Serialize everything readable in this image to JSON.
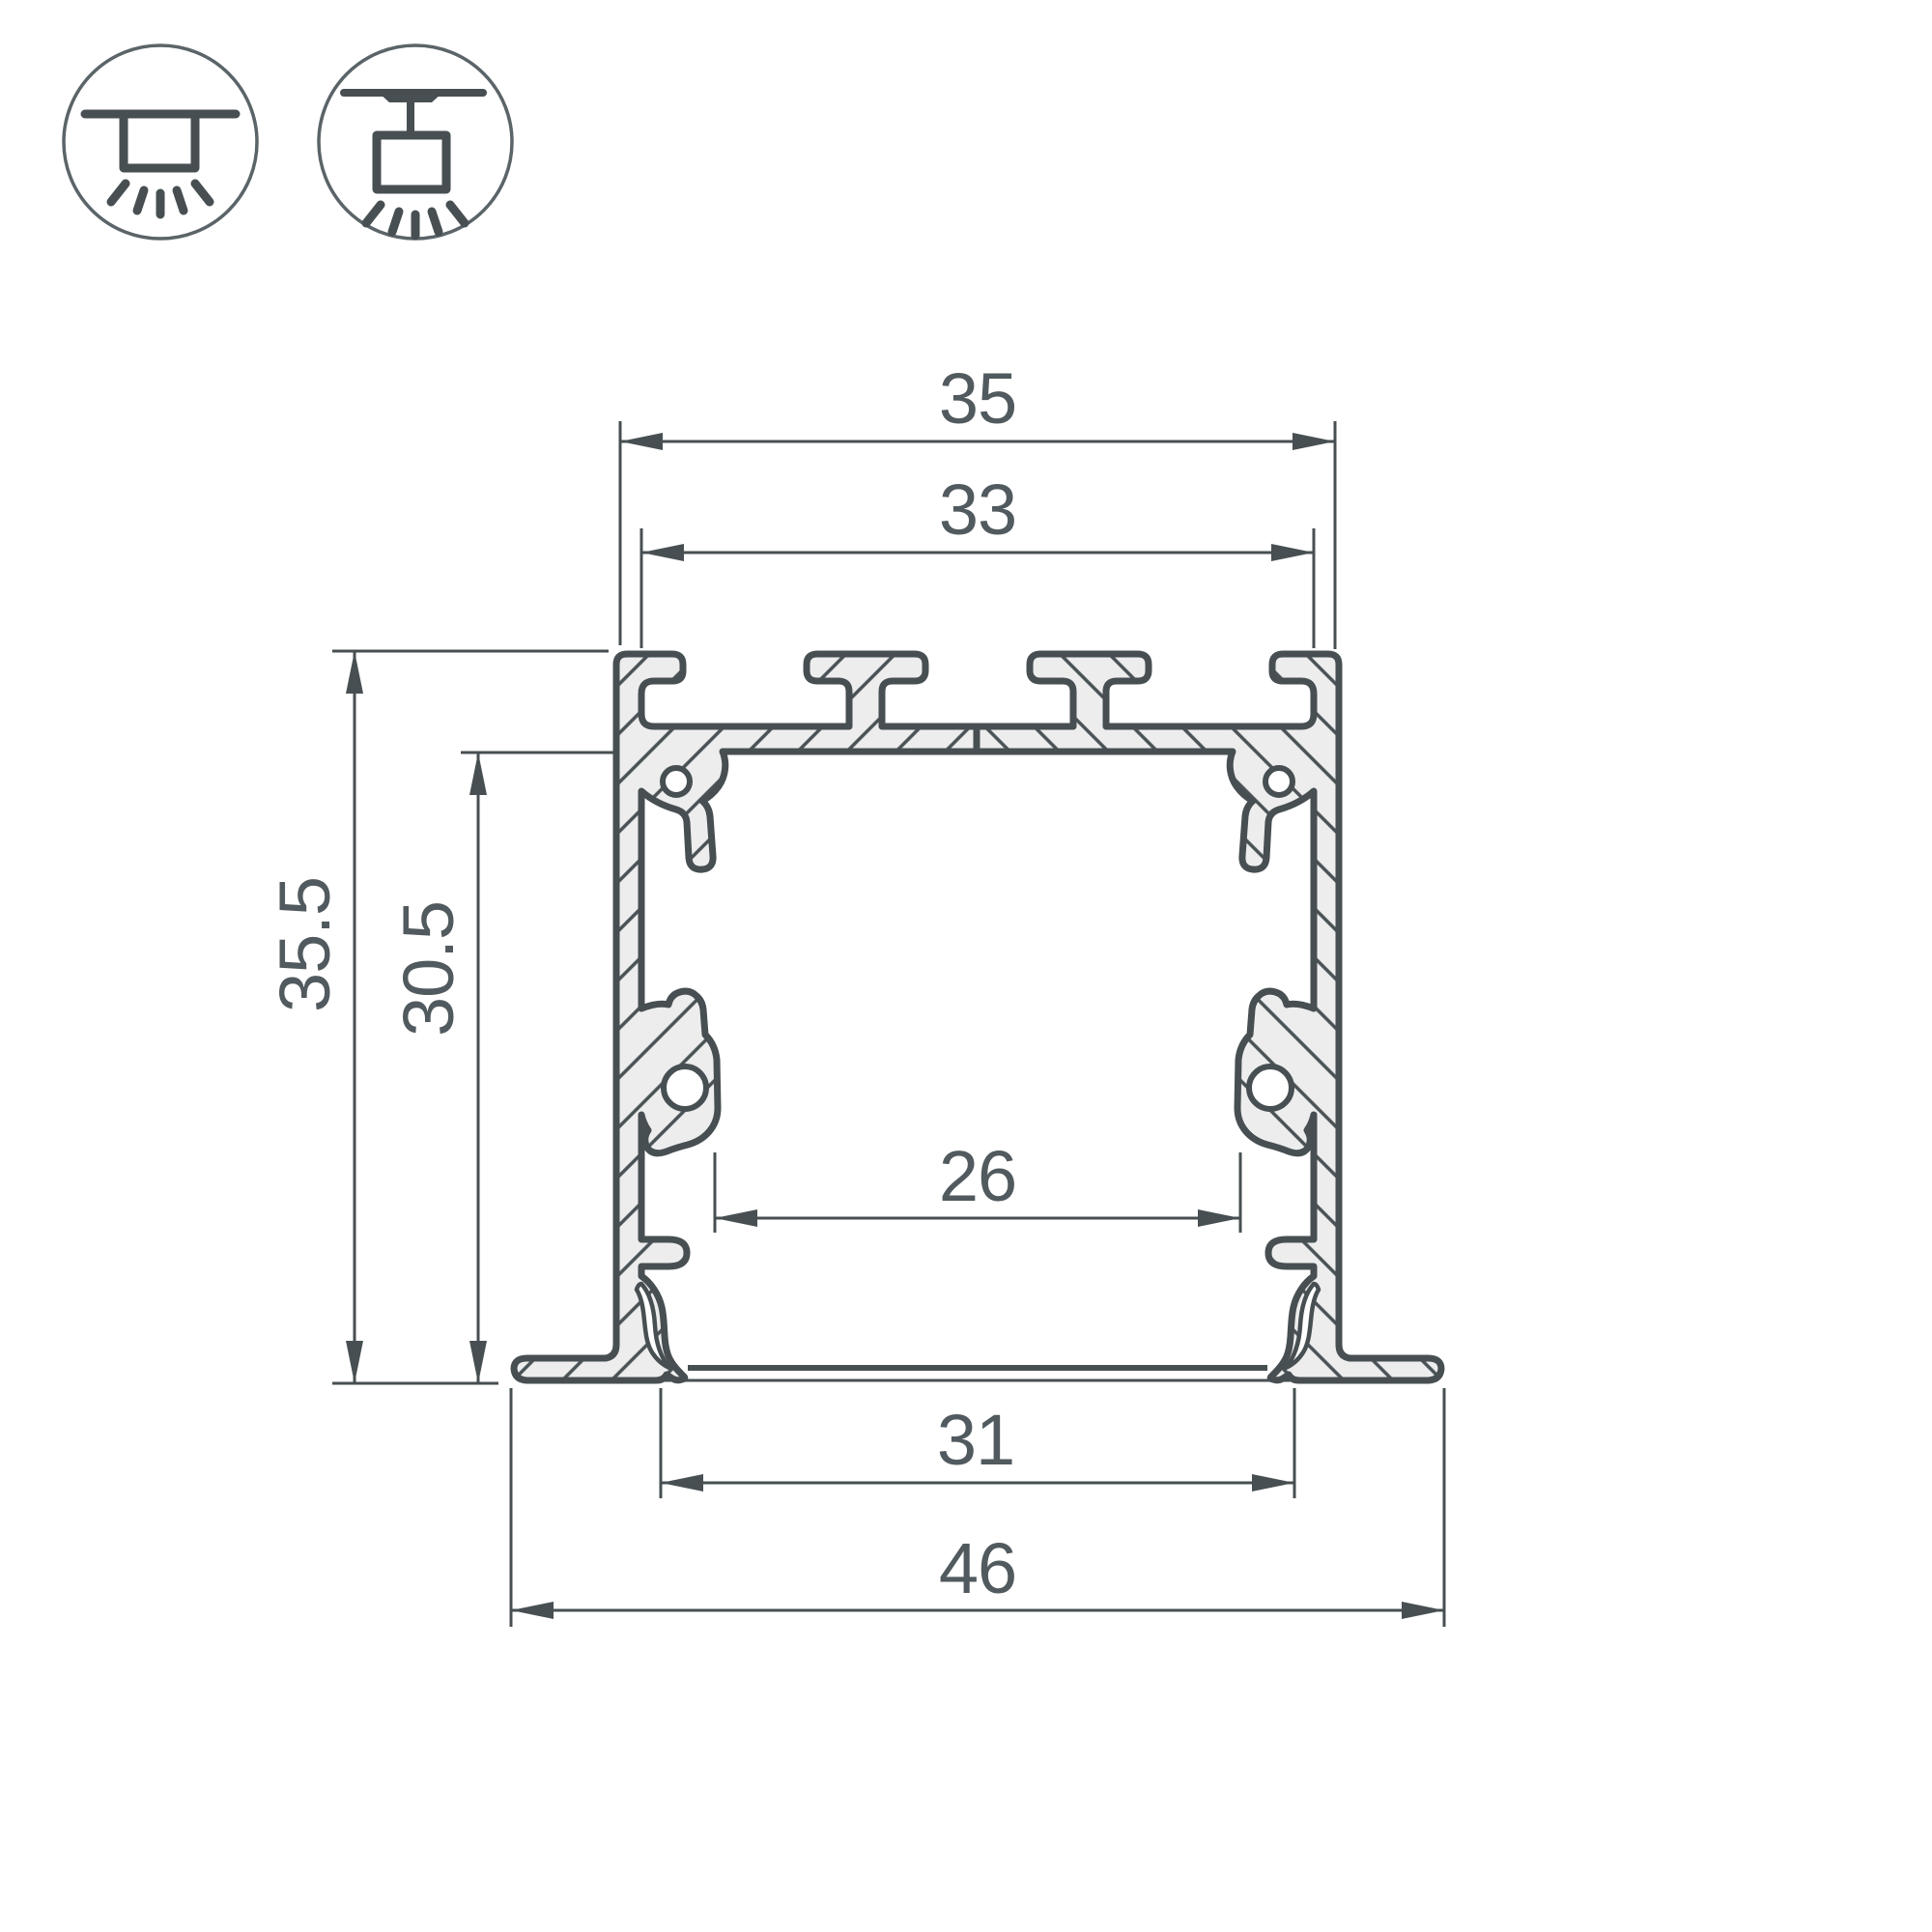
{
  "drawing": {
    "type": "aluminium-profile-cross-section",
    "dimensions": {
      "outer_top_width": "35",
      "inner_top_width": "33",
      "total_height": "35.5",
      "inner_height": "30.5",
      "inner_bottom_width": "26",
      "body_bottom_width": "31",
      "flange_overall_width": "46"
    },
    "units": "mm",
    "colors": {
      "background": "#ffffff",
      "line": "#474f52",
      "metal_fill": "#ededed",
      "hatch": "#4a5256",
      "text": "#515a5e"
    },
    "icons": [
      {
        "name": "recessed-mount-icon"
      },
      {
        "name": "pendant-mount-icon"
      }
    ]
  }
}
